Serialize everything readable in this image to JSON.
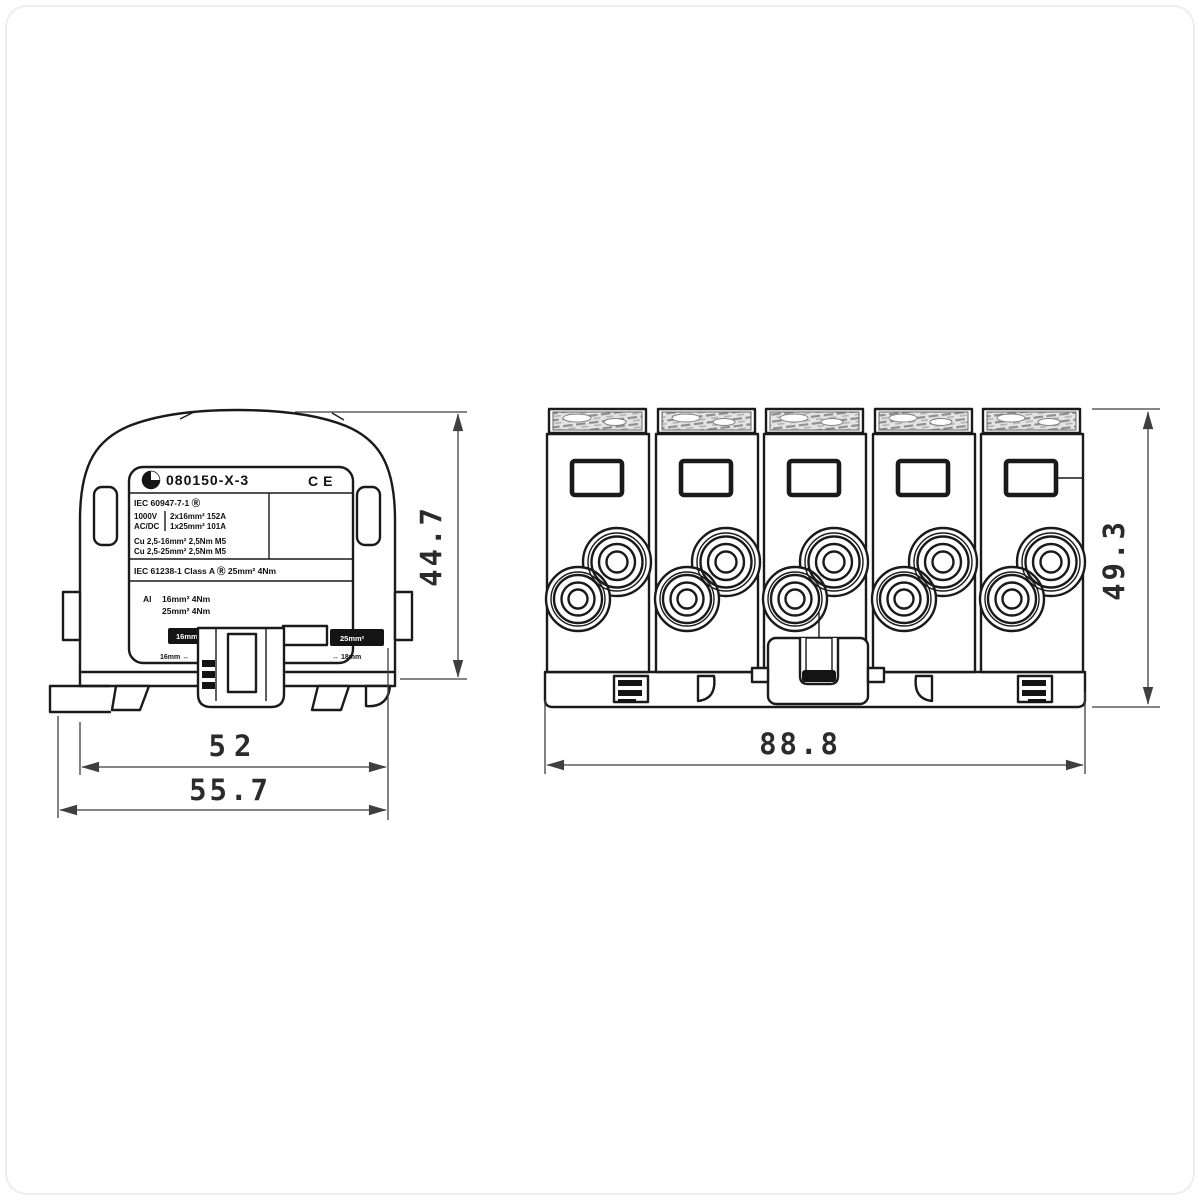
{
  "drawing_title": "terminal block dimensional drawing",
  "views": {
    "side": {
      "label_plate": {
        "part_number": "080150-X-3",
        "ce": "CE",
        "std1": "IEC 60947-7-1  Ⓡ",
        "voltage": "1000V",
        "acdc": "AC/DC",
        "rating1": "2x16mm²  152A",
        "rating2": "1x25mm²  101A",
        "cu1": "Cu 2,5-16mm²  2,5Nm  M5",
        "cu2": "Cu 2,5-25mm²  2,5Nm  M5",
        "std2": "IEC 61238-1   Class A   Ⓡ   25mm²   4Nm",
        "al_prefix": "Al",
        "al1": "16mm²   4Nm",
        "al2": "25mm²   4Nm"
      },
      "tags": {
        "left_box": "16mm²",
        "left_note": "16mm ↔",
        "right_box": "25mm²",
        "right_note": "↔ 18mm"
      },
      "dims": {
        "height": "44.7",
        "width_inner": "52",
        "width_outer": "55.7"
      }
    },
    "front": {
      "dims": {
        "height": "49.3",
        "width": "88.8"
      }
    }
  }
}
